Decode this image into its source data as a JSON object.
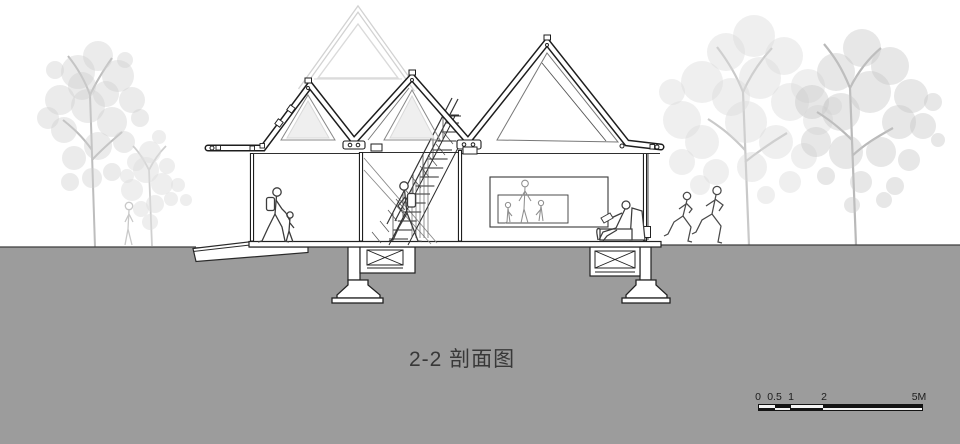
{
  "title": "2-2 剖面图",
  "scalebar": {
    "labels": [
      "0",
      "0.5",
      "1",
      "2",
      "5M"
    ]
  },
  "colors": {
    "ground_gray": "#9c9c9c",
    "line_dark": "#222222",
    "tree_gray_light": "#d8d8d8",
    "tree_gray_lighter": "#dedede",
    "tree_gray_mid": "#c5c5c5",
    "faint_structure_gray": "#d2d2d2",
    "title_text": "#383838",
    "scalebar_black": "#141414"
  }
}
